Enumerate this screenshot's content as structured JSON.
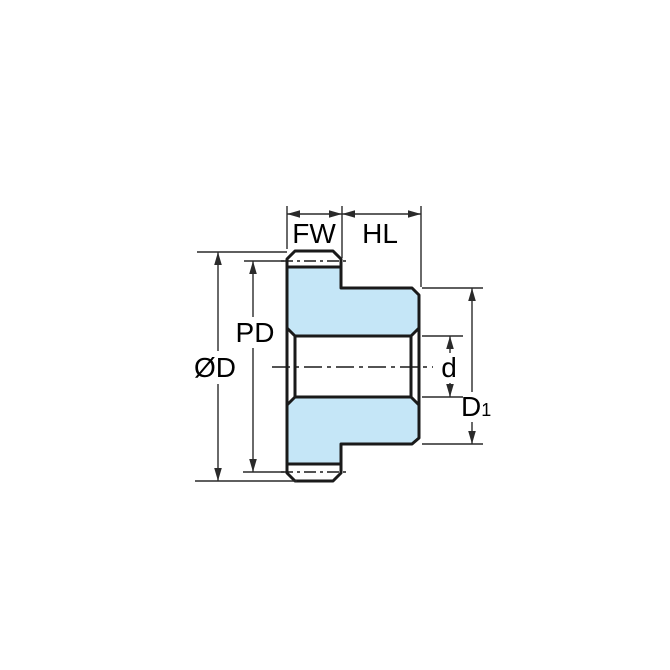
{
  "diagram": {
    "kind": "engineering-dimension-drawing",
    "subject": "spur gear with hub, side cross-section view",
    "colors": {
      "background": "#FFFFFF",
      "part_fill": "#C5E6F7",
      "outline": "#1A1A1A",
      "dimension": "#2A2A2A",
      "text": "#000000"
    },
    "labels": {
      "face_width": "FW",
      "hub_length": "HL",
      "pitch_diameter": "PD",
      "outer_diameter": "ØD",
      "bore_diameter": "d",
      "hub_diameter_main": "D",
      "hub_diameter_sub": "1"
    }
  }
}
